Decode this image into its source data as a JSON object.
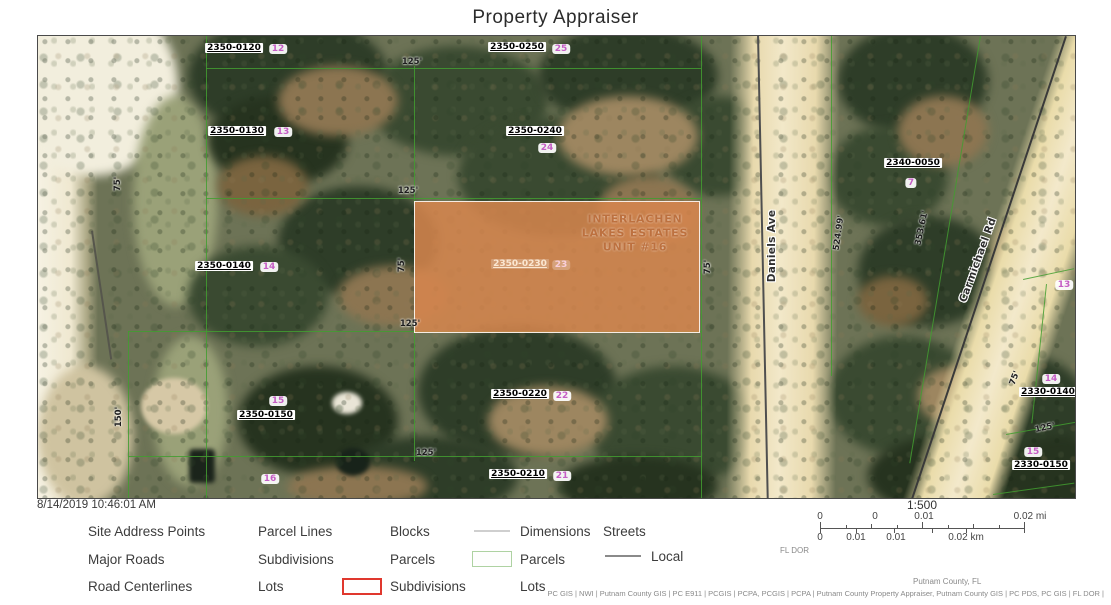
{
  "page": {
    "title": "Property Appraiser"
  },
  "timestamp": "8/14/2019 10:46:01 AM",
  "map": {
    "subdivision": {
      "line1": "INTERLACHEN",
      "line2": "LAKES ESTATES",
      "line3": "UNIT #16"
    },
    "highlight_parcel": {
      "id": "2350-0230",
      "lot": "23"
    },
    "labels": [
      {
        "t": "2350-0120",
        "k": "pid",
        "x": 196,
        "y": 12
      },
      {
        "t": "12",
        "k": "lot",
        "x": 240,
        "y": 13
      },
      {
        "t": "125'",
        "k": "dim",
        "x": 374,
        "y": 26
      },
      {
        "t": "2350-0250",
        "k": "pid",
        "x": 479,
        "y": 11
      },
      {
        "t": "25",
        "k": "lot",
        "x": 523,
        "y": 13
      },
      {
        "t": "2350-0130",
        "k": "pid",
        "x": 199,
        "y": 95
      },
      {
        "t": "13",
        "k": "lot",
        "x": 245,
        "y": 96
      },
      {
        "t": "2350-0240",
        "k": "pid",
        "x": 497,
        "y": 95
      },
      {
        "t": "24",
        "k": "lot",
        "x": 509,
        "y": 112
      },
      {
        "t": "75'",
        "k": "dim",
        "x": 80,
        "y": 148,
        "r": -90
      },
      {
        "t": "2350-0140",
        "k": "pid",
        "x": 186,
        "y": 230
      },
      {
        "t": "14",
        "k": "lot",
        "x": 231,
        "y": 231
      },
      {
        "t": "125'",
        "k": "dim",
        "x": 370,
        "y": 155
      },
      {
        "t": "75'",
        "k": "dim",
        "x": 364,
        "y": 229,
        "r": -90
      },
      {
        "t": "125'",
        "k": "dim",
        "x": 372,
        "y": 288
      },
      {
        "t": "2350-0230",
        "k": "ghost-pid",
        "x": 482,
        "y": 228
      },
      {
        "t": "23",
        "k": "ghost-lot",
        "x": 523,
        "y": 229
      },
      {
        "t": "75'",
        "k": "dim",
        "x": 670,
        "y": 231,
        "r": -90
      },
      {
        "t": "15",
        "k": "lot",
        "x": 240,
        "y": 365
      },
      {
        "t": "2350-0150",
        "k": "pid",
        "x": 228,
        "y": 379
      },
      {
        "t": "150'",
        "k": "dim",
        "x": 81,
        "y": 381,
        "r": -90
      },
      {
        "t": "16",
        "k": "lot",
        "x": 232,
        "y": 443
      },
      {
        "t": "2350-0220",
        "k": "pid",
        "x": 482,
        "y": 358
      },
      {
        "t": "22",
        "k": "lot",
        "x": 524,
        "y": 360
      },
      {
        "t": "125'",
        "k": "dim",
        "x": 388,
        "y": 417
      },
      {
        "t": "2350-0210",
        "k": "pid",
        "x": 480,
        "y": 438
      },
      {
        "t": "21",
        "k": "lot",
        "x": 524,
        "y": 440
      },
      {
        "t": "Daniels Ave",
        "k": "street",
        "x": 734,
        "y": 210,
        "r": -90
      },
      {
        "t": "2340-0050",
        "k": "pid",
        "x": 875,
        "y": 127
      },
      {
        "t": "7",
        "k": "lot",
        "x": 873,
        "y": 147
      },
      {
        "t": "524.99'",
        "k": "dim",
        "x": 801,
        "y": 197,
        "r": -82
      },
      {
        "t": "353.61'",
        "k": "dim",
        "x": 884,
        "y": 192,
        "r": -78
      },
      {
        "t": "Carmichael Rd",
        "k": "street",
        "x": 940,
        "y": 224,
        "r": -70
      },
      {
        "t": "13",
        "k": "lot",
        "x": 1026,
        "y": 249
      },
      {
        "t": "75'",
        "k": "dim",
        "x": 977,
        "y": 342,
        "r": -70
      },
      {
        "t": "14",
        "k": "lot",
        "x": 1013,
        "y": 343
      },
      {
        "t": "2330-0140",
        "k": "pid",
        "x": 1010,
        "y": 356
      },
      {
        "t": "125'",
        "k": "dim",
        "x": 1007,
        "y": 392,
        "r": -12
      },
      {
        "t": "15",
        "k": "lot",
        "x": 995,
        "y": 416
      },
      {
        "t": "2330-0150",
        "k": "pid",
        "x": 1003,
        "y": 429
      }
    ]
  },
  "legend": {
    "columns": [
      {
        "x": 88,
        "items": [
          {
            "label": "Site Address Points"
          },
          {
            "label": "Major Roads"
          },
          {
            "label": "Road Centerlines"
          }
        ]
      },
      {
        "x": 258,
        "items": [
          {
            "label": "Parcel Lines"
          },
          {
            "label": "Subdivisions"
          },
          {
            "label": "Lots"
          }
        ]
      },
      {
        "x": 390,
        "items": [
          {
            "label": "Blocks"
          },
          {
            "label": "Parcels"
          },
          {
            "label": "Subdivisions",
            "swatch": "red-rect"
          }
        ]
      },
      {
        "x": 520,
        "items": [
          {
            "label": "Dimensions",
            "swatch": "gray-line"
          },
          {
            "label": "Parcels",
            "swatch": "green-rect"
          },
          {
            "label": "Lots"
          }
        ]
      }
    ],
    "streets_label": "Streets",
    "local_label": "Local"
  },
  "scalebar": {
    "ratio": "1:500",
    "mi_labels": [
      {
        "t": "0",
        "x": 820
      },
      {
        "t": "0",
        "x": 875
      },
      {
        "t": "0.01",
        "x": 924
      },
      {
        "t": "0.02 mi",
        "x": 1030
      }
    ],
    "km_labels": [
      {
        "t": "0",
        "x": 820
      },
      {
        "t": "0.01",
        "x": 856
      },
      {
        "t": "0.01",
        "x": 896
      },
      {
        "t": "0.02 km",
        "x": 966
      }
    ],
    "source": "FL DOR"
  },
  "attribution": {
    "line1": "Putnam County, FL",
    "line2": "PC GIS | NWI | Putnam County GIS | PC E911 | PCGIS | PCPA, PCGIS | PCPA | Putnam County Property Appraiser, Putnam County GIS | PC PDS, PC GIS | FL DOR |"
  },
  "colors": {
    "highlight_parcel": "#d8864e",
    "parcel_line_green": "#429e30",
    "lot_badge_pink": "#c55ec5",
    "legend_red": "#e0382e",
    "legend_green": "#aed2a2"
  }
}
